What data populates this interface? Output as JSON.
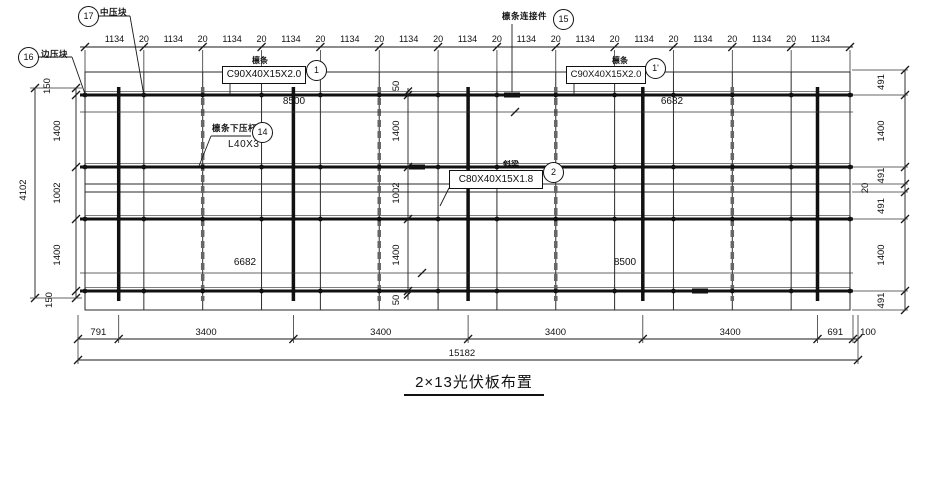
{
  "drawing": {
    "title": "2×13光伏板布置",
    "colors": {
      "line": "#1a1a1a",
      "background": "#ffffff"
    },
    "top_chain": {
      "panel_dim": "1134",
      "gap_dim": "20",
      "panel_count": 13
    },
    "left_chain": {
      "segments": [
        "150",
        "1400",
        "1002",
        "1400",
        "150"
      ],
      "overall": "4102"
    },
    "mid_chain": {
      "segments": [
        "50",
        "1400",
        "1002",
        "1400",
        "50"
      ]
    },
    "right_chain": {
      "segments": [
        "491",
        "1400",
        "491",
        "20",
        "491",
        "1400",
        "491"
      ]
    },
    "bottom_chain": {
      "segments": [
        "791",
        "3400",
        "3400",
        "3400",
        "3400",
        "691",
        "100"
      ],
      "overall": "15182"
    },
    "interior_dims": {
      "purlin_top_left": "8500",
      "purlin_top_right": "6682",
      "purlin_bottom_left": "6682",
      "purlin_bottom_right": "8500"
    },
    "callouts": {
      "edge_clamp": {
        "bubble": "16",
        "label": "边压块"
      },
      "mid_clamp": {
        "bubble": "17",
        "label": "中压块"
      },
      "purlin_left": {
        "bubble": "1",
        "label": "檩条",
        "spec": "C90X40X15X2.0"
      },
      "purlin_right": {
        "bubble": "1'",
        "label": "檩条",
        "spec": "C90X40X15X2.0"
      },
      "purlin_connector": {
        "bubble": "15",
        "label": "檩条连接件"
      },
      "purlin_brace": {
        "bubble": "14",
        "label": "檩条下压杆",
        "spec": "L40X3"
      },
      "rafter": {
        "bubble": "2",
        "label": "斜梁",
        "spec": "C80X40X15X1.8"
      }
    }
  }
}
